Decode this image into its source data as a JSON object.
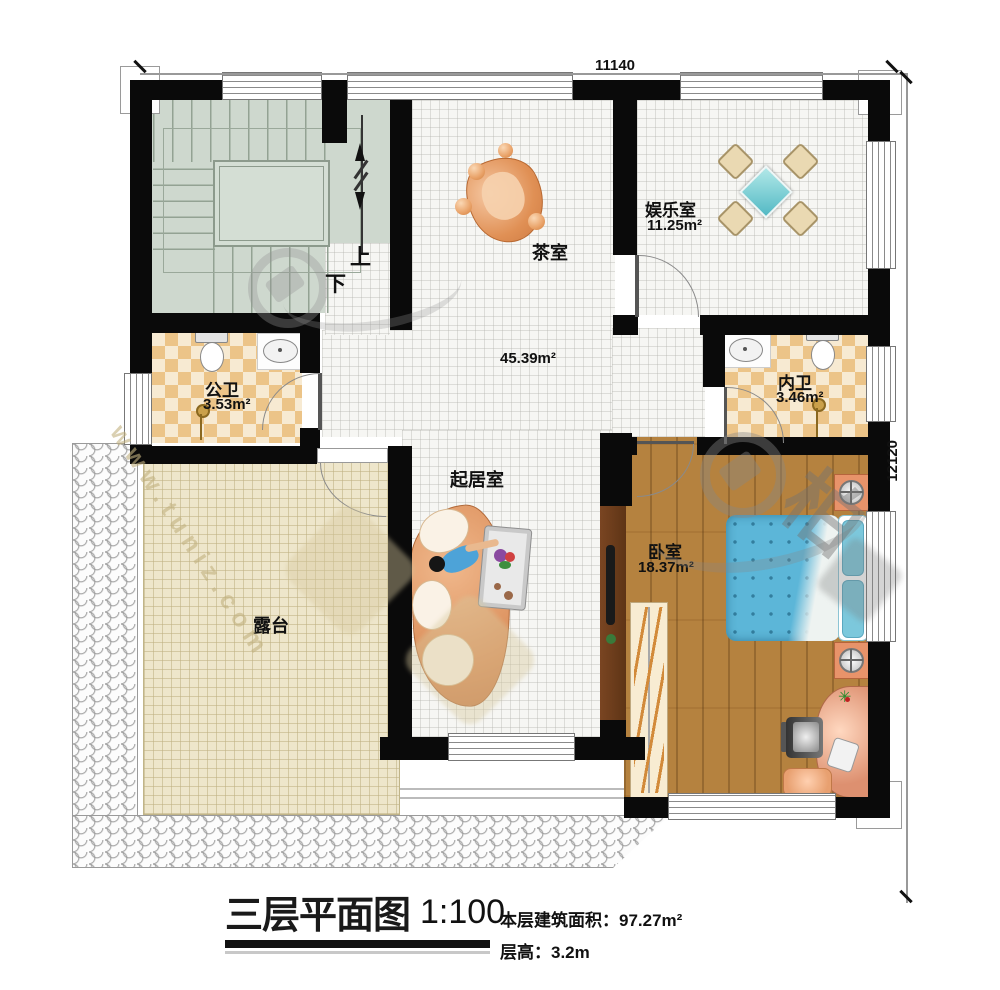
{
  "dimensions": {
    "width_mm": "11140",
    "height_mm": "12120"
  },
  "stairs": {
    "up": "上",
    "down": "下"
  },
  "rooms": {
    "tea": {
      "name": "茶室"
    },
    "entertainment": {
      "name": "娱乐室",
      "area": "11.25m²"
    },
    "public_bath": {
      "name": "公卫",
      "area": "3.53m²"
    },
    "private_bath": {
      "name": "内卫",
      "area": "3.46m²"
    },
    "living": {
      "name": "起居室",
      "area": "45.39m²"
    },
    "bedroom": {
      "name": "卧室",
      "area": "18.37m²"
    },
    "terrace": {
      "name": "露台"
    }
  },
  "title_block": {
    "title": "三层平面图",
    "scale": "1:100",
    "floor_area": "本层建筑面积：97.27m²",
    "floor_height": "层高：3.2m"
  },
  "watermark": {
    "site": "www.tuniz.com",
    "logo_char": "柏"
  },
  "colors": {
    "wall": "#0a0a0a",
    "wood_floor": "#b5823f",
    "bed_blue": "#5cb6d8",
    "bath_tile": "#ecc488",
    "terrace_tile": "#eee6cb",
    "sofa_orange": "#d98a55"
  }
}
